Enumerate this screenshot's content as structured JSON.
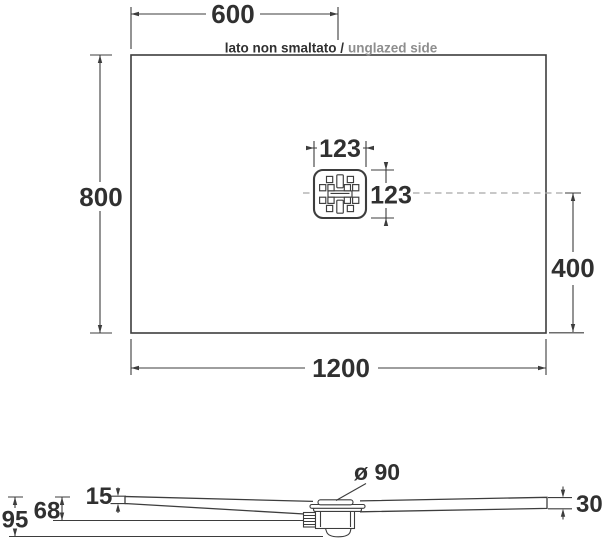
{
  "drawing": {
    "top_view": {
      "dim_width_half": "600",
      "dim_height": "800",
      "dim_width_total": "1200",
      "dim_drain_offset": "400",
      "dim_drain_width": "123",
      "dim_drain_height": "123",
      "edge_label_italian": "lato non smaltato /",
      "edge_label_english": "unglazed side"
    },
    "side_view": {
      "dim_edge_thickness": "15",
      "dim_outlet_depth": "68",
      "dim_total_depth": "95",
      "dim_opposite_thickness": "30",
      "dim_drain_diameter": "ø 90"
    }
  },
  "colors": {
    "line": "#3d3d3d",
    "text": "#303030",
    "muted": "#8e8e8e",
    "dash": "#a6a6a6",
    "background": "#ffffff"
  }
}
